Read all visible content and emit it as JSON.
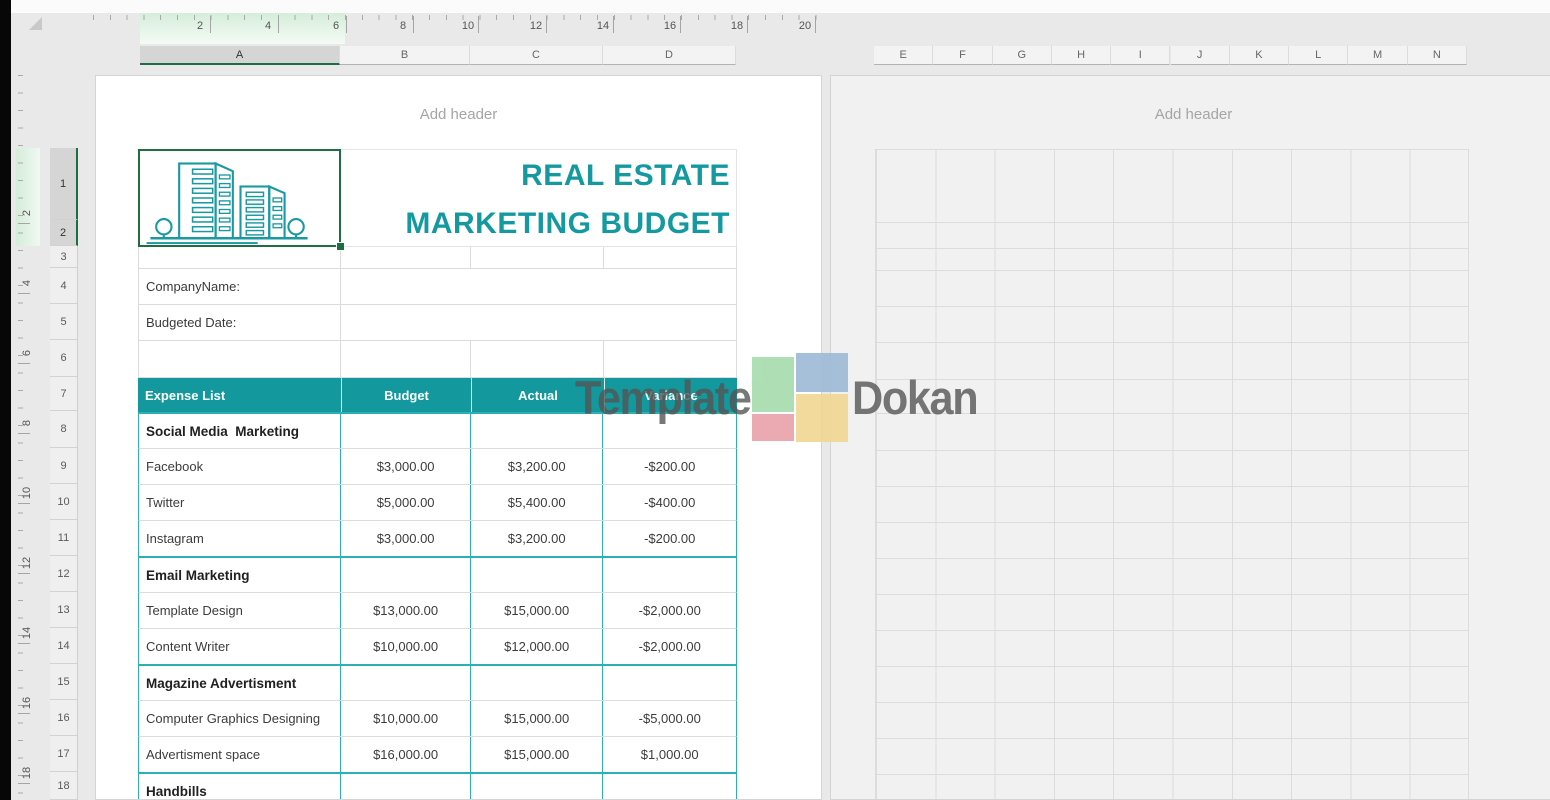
{
  "ruler_h": {
    "numbers": [
      "2",
      "4",
      "6",
      "8",
      "10",
      "12",
      "14",
      "16",
      "18",
      "20"
    ]
  },
  "ruler_v": {
    "numbers": [
      "2",
      "4",
      "6",
      "8",
      "10",
      "12",
      "14",
      "16",
      "18"
    ]
  },
  "columns_left": [
    "A",
    "B",
    "C",
    "D"
  ],
  "columns_right": [
    "E",
    "F",
    "G",
    "H",
    "I",
    "J",
    "K",
    "L",
    "M",
    "N"
  ],
  "row_numbers": [
    "1",
    "2",
    "3",
    "4",
    "5",
    "6",
    "7",
    "8",
    "9",
    "10",
    "11",
    "12",
    "13",
    "14",
    "15",
    "16",
    "17",
    "18"
  ],
  "selection": {
    "selected_columns": "A",
    "selected_rows": "1:2"
  },
  "left_page": {
    "header_placeholder": "Add header",
    "title_line1": "REAL ESTATE",
    "title_line2": "MARKETING BUDGET",
    "company_label": "CompanyName:",
    "date_label": "Budgeted Date:",
    "table": {
      "headers": [
        "Expense List",
        "Budget",
        "Actual",
        "Variance"
      ],
      "rows": [
        {
          "type": "section",
          "name": "Social Media  Marketing",
          "budget": "",
          "actual": "",
          "variance": ""
        },
        {
          "type": "data",
          "name": "Facebook",
          "budget": "$3,000.00",
          "actual": "$3,200.00",
          "variance": "-$200.00"
        },
        {
          "type": "data",
          "name": "Twitter",
          "budget": "$5,000.00",
          "actual": "$5,400.00",
          "variance": "-$400.00"
        },
        {
          "type": "data",
          "name": "Instagram",
          "budget": "$3,000.00",
          "actual": "$3,200.00",
          "variance": "-$200.00"
        },
        {
          "type": "section",
          "name": "Email Marketing",
          "budget": "",
          "actual": "",
          "variance": ""
        },
        {
          "type": "data",
          "name": "Template Design",
          "budget": "$13,000.00",
          "actual": "$15,000.00",
          "variance": "-$2,000.00"
        },
        {
          "type": "data",
          "name": "Content Writer",
          "budget": "$10,000.00",
          "actual": "$12,000.00",
          "variance": "-$2,000.00"
        },
        {
          "type": "section",
          "name": "Magazine Advertisment",
          "budget": "",
          "actual": "",
          "variance": ""
        },
        {
          "type": "data",
          "name": "Computer Graphics Designing",
          "budget": "$10,000.00",
          "actual": "$15,000.00",
          "variance": "-$5,000.00"
        },
        {
          "type": "data",
          "name": "Advertisment space",
          "budget": "$16,000.00",
          "actual": "$15,000.00",
          "variance": "$1,000.00"
        },
        {
          "type": "section",
          "name": "Handbills",
          "budget": "",
          "actual": "",
          "variance": ""
        }
      ]
    }
  },
  "right_page": {
    "header_placeholder": "Add header"
  },
  "watermark": {
    "word1": "Template",
    "word2": "Dokan"
  },
  "colors": {
    "accent_teal": "#12989d",
    "table_border_teal": "#2cb0b4",
    "selection_green": "#1e6e41",
    "watermark_text": "#555555",
    "watermark_green": "#a8dcae",
    "watermark_blue": "#a0bbd6",
    "watermark_red": "#eaa2ab",
    "watermark_yellow": "#f0d794"
  }
}
